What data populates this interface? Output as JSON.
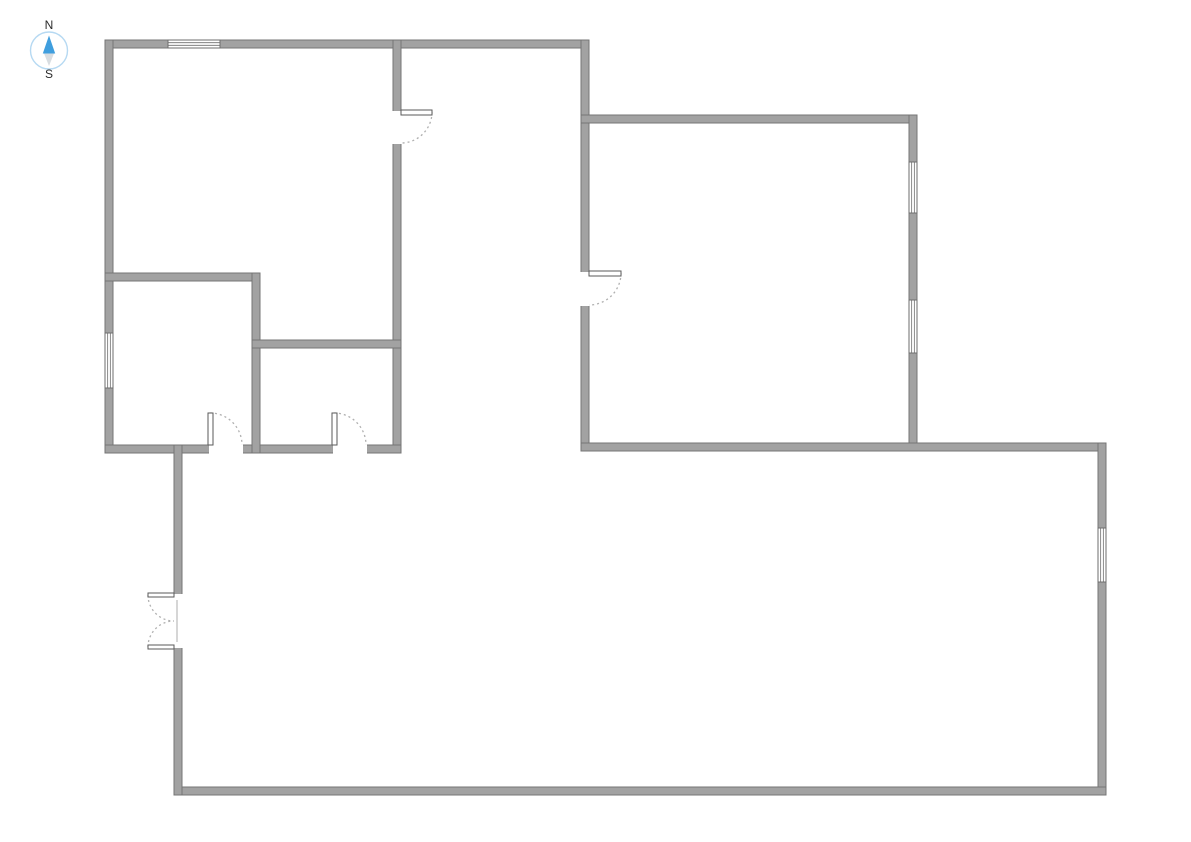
{
  "compass": {
    "north_label": "N",
    "south_label": "S",
    "ring_color": "#b6d9f2",
    "needle_north_color": "#3f9ede",
    "needle_south_color": "#d8dde1",
    "label_color": "#2b2b2b",
    "center": {
      "x": 49,
      "y": 50.5
    },
    "radius": 18.5
  },
  "floor_plan": {
    "canvas": {
      "width": 1191,
      "height": 842,
      "background": "#ffffff"
    },
    "style": {
      "wall_fill": "#a2a2a2",
      "wall_stroke": "#757575",
      "wall_thickness": 8,
      "window_fill": "#ffffff",
      "window_stroke": "#6e6e6e",
      "door_leaf_fill": "#ffffff",
      "door_leaf_stroke": "#5a5a5a",
      "door_arc_color": "#b0b0b0",
      "door_gap_fill": "#ffffff",
      "door_closed_line": "#c9c9c9"
    },
    "walls": [
      {
        "id": "outer-top",
        "x": 105,
        "y": 40,
        "w": 484,
        "h": 8
      },
      {
        "id": "outer-left",
        "x": 105,
        "y": 40,
        "w": 8,
        "h": 413
      },
      {
        "id": "left-section-right",
        "x": 393,
        "y": 40,
        "w": 8,
        "h": 413
      },
      {
        "id": "left-section-bottom",
        "x": 105,
        "y": 445,
        "w": 296,
        "h": 8
      },
      {
        "id": "interior-horizontal-upper",
        "x": 105,
        "y": 273,
        "w": 155,
        "h": 8
      },
      {
        "id": "interior-vertical",
        "x": 252,
        "y": 273,
        "w": 8,
        "h": 180
      },
      {
        "id": "interior-horizontal-lower",
        "x": 252,
        "y": 340,
        "w": 149,
        "h": 8
      },
      {
        "id": "right-room-left",
        "x": 581,
        "y": 40,
        "w": 8,
        "h": 411
      },
      {
        "id": "right-room-top",
        "x": 581,
        "y": 115,
        "w": 336,
        "h": 8
      },
      {
        "id": "right-room-right",
        "x": 909,
        "y": 115,
        "w": 8,
        "h": 336
      },
      {
        "id": "bottom-room-top",
        "x": 581,
        "y": 443,
        "w": 525,
        "h": 8
      },
      {
        "id": "bottom-room-right",
        "x": 1098,
        "y": 443,
        "w": 8,
        "h": 352
      },
      {
        "id": "bottom-room-bottom",
        "x": 174,
        "y": 787,
        "w": 932,
        "h": 8
      },
      {
        "id": "bottom-room-left",
        "x": 174,
        "y": 445,
        "w": 8,
        "h": 350
      }
    ],
    "windows": [
      {
        "id": "window-top-wall",
        "orientation": "h",
        "x": 168,
        "y": 40,
        "length": 52
      },
      {
        "id": "window-left-wall",
        "orientation": "v",
        "x": 105,
        "y": 333,
        "length": 55
      },
      {
        "id": "window-right-room-upper",
        "orientation": "v",
        "x": 909,
        "y": 162,
        "length": 51
      },
      {
        "id": "window-right-room-lower",
        "orientation": "v",
        "x": 909,
        "y": 300,
        "length": 53
      },
      {
        "id": "window-bottom-room-right",
        "orientation": "v",
        "x": 1098,
        "y": 528,
        "length": 54
      }
    ],
    "doors": [
      {
        "id": "door-left-section",
        "gap": [
          392,
          111,
          10,
          33
        ],
        "leaves": [
          [
            401,
            110,
            31,
            5
          ]
        ],
        "arcs": [
          "M432,112 A31,31 0 0 1 401,143"
        ]
      },
      {
        "id": "door-right-room",
        "gap": [
          580,
          272,
          10,
          34
        ],
        "leaves": [
          [
            589,
            271,
            32,
            5
          ]
        ],
        "arcs": [
          "M621,273 A32,32 0 0 1 589,305"
        ]
      },
      {
        "id": "door-small-room-left",
        "gap": [
          209,
          444,
          34,
          10
        ],
        "leaves": [
          [
            208,
            413,
            5,
            32
          ]
        ],
        "arcs": [
          "M210,413 A32,32 0 0 1 242,445"
        ]
      },
      {
        "id": "door-small-room-mid",
        "gap": [
          333,
          444,
          34,
          10
        ],
        "leaves": [
          [
            332,
            413,
            5,
            32
          ]
        ],
        "arcs": [
          "M334,413 A32,32 0 0 1 366,445"
        ]
      },
      {
        "id": "double-door-entry",
        "gap": [
          173,
          594,
          10,
          54
        ],
        "leaves": [
          [
            148,
            593,
            26,
            4
          ],
          [
            148,
            645,
            26,
            4
          ]
        ],
        "arcs": [
          "M148,595 A26,26 0 0 0 174,621",
          "M148,647 A26,26 0 0 1 174,621"
        ],
        "inner_lines": [
          [
            177,
            600,
            177,
            642
          ]
        ]
      }
    ]
  }
}
